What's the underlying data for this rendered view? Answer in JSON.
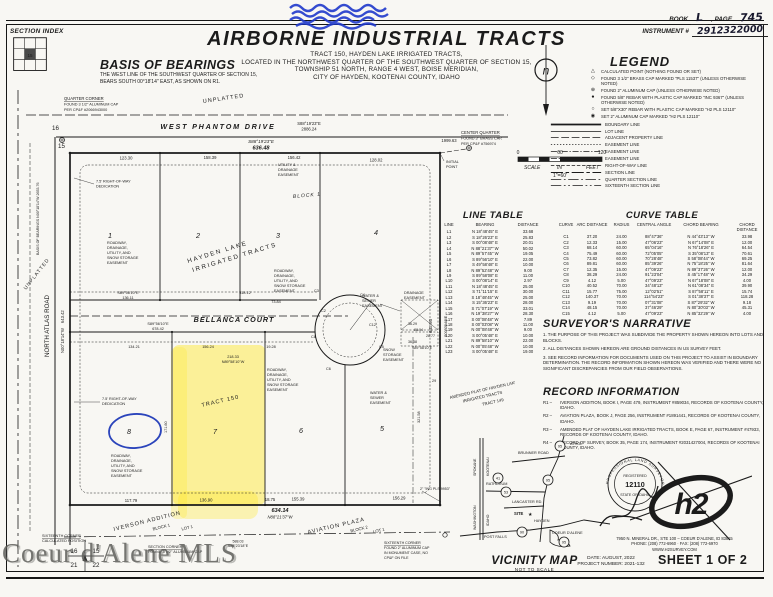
{
  "doc": {
    "section_index": {
      "label": "SECTION INDEX",
      "cell": "15"
    },
    "title": "AIRBORNE INDUSTRIAL TRACTS",
    "subtitle_lines": [
      "TRACT 150, HAYDEN LAKE IRRIGATED TRACTS,",
      "LOCATED IN THE NORTHWEST QUARTER OF THE SOUTHWEST QUARTER OF SECTION 15,",
      "TOWNSHIP 51 NORTH, RANGE 4 WEST, BOISE MERIDIAN,",
      "CITY OF HAYDEN, KOOTENAI COUNTY, IDAHO"
    ],
    "book": {
      "label": "BOOK",
      "value": "L",
      "page_label": ", PAGE",
      "page_value": "745",
      "instr_label": "INSTRUMENT #",
      "instr_value": "2912322000"
    },
    "watermark": "Coeur d'Alene MLS"
  },
  "basis": {
    "title": "BASIS OF BEARINGS",
    "body": "THE WEST LINE OF THE SOUTHWEST QUARTER OF SECTION 15, BEARS SOUTH 00°18'14\" EAST, AS SHOWN ON R1."
  },
  "north_arrow": {
    "letter": "n"
  },
  "scale": {
    "t0": "0",
    "t1": "60",
    "t2": "120",
    "w1": "SCALE",
    "w2": "IN",
    "w3": "FEET",
    "ratio": "1\"=60'"
  },
  "legend": {
    "title": "LEGEND",
    "points": [
      {
        "sym": "△",
        "text": "CALCULATED POINT (NOTHING FOUND OR SET)"
      },
      {
        "sym": "◇",
        "text": "FOUND 3 1/2\" BRASS CAP MARKED \"PLS 11537\" (UNLESS OTHERWISE NOTED)"
      },
      {
        "sym": "⊕",
        "text": "FOUND 2\" ALUMINUM CAP (UNLESS OTHERWISE NOTED)"
      },
      {
        "sym": "●",
        "text": "FOUND 5/8\" REBAR WITH PLASTIC CAP MARKED \"INC 9367\" (UNLESS OTHERWISE NOTED)"
      },
      {
        "sym": "○",
        "text": "SET 5/8\"X30\" REBAR WITH PLASTIC CAP MARKED \"H2 PLS 12110\""
      },
      {
        "sym": "◉",
        "text": "SET 2\" ALUMINUM CAP MARKED \"H2 PLS 12110\""
      }
    ],
    "lines": [
      {
        "dash": "",
        "w": "2",
        "text": "BOUNDARY LINE"
      },
      {
        "dash": "",
        "w": "1",
        "text": "LOT LINE"
      },
      {
        "dash": "9 3",
        "w": "1",
        "text": "ADJACENT PROPERTY LINE"
      },
      {
        "dash": "1.5 2",
        "w": "0.8",
        "text": "EASEMENT LINE"
      },
      {
        "dash": "7 2 1.5 2",
        "w": "0.8",
        "text": "EASEMENT LINE"
      },
      {
        "dash": "7 2 1.5 2 1.5 2",
        "w": "0.8",
        "text": "EASEMENT LINE"
      },
      {
        "dash": "4 2",
        "w": "0.8",
        "text": "RIGHT-OF-WAY LINE"
      },
      {
        "dash": "14 3 4 3",
        "w": "1.2",
        "text": "SECTION LINE"
      },
      {
        "dash": "12 3 2 3",
        "w": "1",
        "text": "QUARTER SECTION LINE"
      },
      {
        "dash": "12 3 2 3 2 3",
        "w": "1",
        "text": "SIXTEENTH SECTION LINE"
      }
    ]
  },
  "line_table": {
    "title": "LINE TABLE",
    "headers": [
      "LINE",
      "BEARING",
      "DISTANCE"
    ],
    "rows": [
      [
        "L1",
        "N 18°48'45\" E",
        "33.68"
      ],
      [
        "L2",
        "S 18°26'23\" E",
        "25.83"
      ],
      [
        "L3",
        "S 00°08'48\" E",
        "20.01"
      ],
      [
        "L4",
        "N 88°21'37\" W",
        "50.02"
      ],
      [
        "L5",
        "N 89°57'45\" W",
        "19.05"
      ],
      [
        "L6",
        "S 89°56'10\" E",
        "22.00"
      ],
      [
        "L7",
        "S 49°58'48\" E",
        "10.00"
      ],
      [
        "L8",
        "N 89°52'48\" W",
        "9.00"
      ],
      [
        "L9",
        "S 89°58'08\" E",
        "11.00"
      ],
      [
        "L10",
        "S 00°08'14\" E",
        "2.97"
      ],
      [
        "L11",
        "N 18°48'45\" E",
        "25.00"
      ],
      [
        "L12",
        "S 71°11'15\" E",
        "30.00"
      ],
      [
        "L13",
        "S 18°48'45\" W",
        "25.00"
      ],
      [
        "L14",
        "S 15°36'23\" E",
        "28.00"
      ],
      [
        "L15",
        "S 71°07'19\" W",
        "33.01"
      ],
      [
        "L16",
        "N 19°38'27\" W",
        "28.30"
      ],
      [
        "L17",
        "S 00°08'48\" W",
        "7.89"
      ],
      [
        "L18",
        "S 00°03'08\" W",
        "11.00"
      ],
      [
        "L19",
        "N 00°08'48\" W",
        "9.00"
      ],
      [
        "L20",
        "S 00°05'48\" E",
        "10.00"
      ],
      [
        "L21",
        "N 89°58'10\" W",
        "22.00"
      ],
      [
        "L22",
        "N 00°05'48\" W",
        "10.00"
      ],
      [
        "L23",
        "S 00°05'48\" E",
        "19.00"
      ]
    ]
  },
  "curve_table": {
    "title": "CURVE TABLE",
    "headers": [
      "CURVE",
      "ARC DISTANCE",
      "RADIUS",
      "CENTRAL ANGLE",
      "CHORD BEARING",
      "CHORD DISTANCE"
    ],
    "rows": [
      [
        "C1",
        "37.20",
        "24.00",
        "88°47'36\"",
        "N 44°43'13\" W",
        "33.98"
      ],
      [
        "C2",
        "12.33",
        "15.00",
        "47°06'23\"",
        "N 67°14'08\" E",
        "12.00"
      ],
      [
        "C3",
        "68.14",
        "60.00",
        "65°04'16\"",
        "N 76°18'26\" E",
        "64.54"
      ],
      [
        "C4",
        "75.49",
        "60.00",
        "72°05'05\"",
        "S 35°08'13\" E",
        "70.61"
      ],
      [
        "C5",
        "73.82",
        "60.00",
        "70°28'48\"",
        "S 58°08'44\" W",
        "69.25"
      ],
      [
        "C6",
        "89.81",
        "60.00",
        "85°39'26\"",
        "N 75°18'25\" W",
        "81.64"
      ],
      [
        "C7",
        "12.35",
        "15.00",
        "47°09'23\"",
        "N 89°37'26\" W",
        "12.00"
      ],
      [
        "C8",
        "38.29",
        "24.00",
        "91°23'04\"",
        "S 45°17'48\" W",
        "34.29"
      ],
      [
        "C9",
        "4.12",
        "5.00",
        "47°09'23\"",
        "N 67°18'08\" E",
        "4.00"
      ],
      [
        "C10",
        "40.52",
        "70.00",
        "34°48'13\"",
        "N 61°08'34\" E",
        "39.90"
      ],
      [
        "C11",
        "15.77",
        "75.00",
        "12°02'51\"",
        "S 87°58'11\" E",
        "15.74"
      ],
      [
        "C12",
        "140.37",
        "70.00",
        "114°54'23\"",
        "S 01°38'37\" E",
        "118.28"
      ],
      [
        "C13",
        "9.19",
        "70.00",
        "07°31'08\"",
        "S 87°29'32\" W",
        "9.18"
      ],
      [
        "C14",
        "48.15",
        "70.00",
        "37°46'29\"",
        "N 80°30'03\" W",
        "45.31"
      ],
      [
        "C15",
        "4.12",
        "5.00",
        "47°09'23\"",
        "N 85°32'29\" W",
        "4.00"
      ]
    ]
  },
  "narrative": {
    "title": "SURVEYOR'S NARRATIVE",
    "notes": [
      "1.  THE PURPOSE OF THIS PROJECT WAS SUBDIVIDE THE PROPERTY SHOWN HEREON INTO LOTS AND BLOCKS.",
      "2.  ALL DISTANCES SHOWN HEREON ARE GROUND DISTANCES IN US SURVEY FEET.",
      "3.  SEE RECORD INFORMATION FOR DOCUMENTS USED ON THIS PROJECT TO ASSIST IN BOUNDARY DETERMINATION. THE RECORD INFORMATION SHOWN HEREON WAS VERIFIED AND THERE WERE NO SIGNIFICANT DISCREPANCIES FROM OUR FIELD OBSERVATIONS."
    ]
  },
  "record": {
    "title": "RECORD INFORMATION",
    "items": [
      {
        "id": "R1 –",
        "text": "IVERSON ADDITION, BOOK I, PAGE 479, INSTRUMENT #859034, RECORDS OF KOOTENAI COUNTY, IDAHO."
      },
      {
        "id": "R2 –",
        "text": "AVIATION PLAZA, BOOK J, PAGE 256, INSTRUMENT #1891441, RECORDS OF KOOTENAI COUNTY, IDAHO."
      },
      {
        "id": "R3 –",
        "text": "AMENDED PLAT OF HAYDEN LAKE IRRIGATED TRACTS, BOOK E, PAGE 67, INSTRUMENT #47933, RECORDS OF KOOTENAI COUNTY, IDAHO."
      },
      {
        "id": "R4 –",
        "text": "RECORD OF SURVEY, BOOK 35, PAGE 174, INSTRUMENT #2031427004, RECORDS OF KOOTENAI COUNTY, IDAHO."
      }
    ]
  },
  "vicinity": {
    "title": "VICINITY MAP",
    "subtitle": "NOT TO SCALE",
    "labels": {
      "athol": "ATHOL",
      "brunner": "BRUNNER ROAD",
      "rathdrum": "RATHDRUM",
      "lancaster": "LANCASTER RD.",
      "site": "SITE",
      "hayden": "HAYDEN",
      "cda": "COEUR D'ALENE",
      "post_falls": "POST FALLS",
      "spokane": "SPOKANE",
      "kootenai": "KOOTENAI",
      "washington": "WASHINGTON",
      "idaho": "IDAHO"
    },
    "shields": [
      "95",
      "41",
      "53",
      "95",
      "90",
      "95"
    ]
  },
  "stamp": {
    "ring_top": "PROFESSIONAL LAND SURVEYOR",
    "ring_mid": "REGISTERED",
    "number": "12110",
    "ring_bottom": "STATE OF IDAHO"
  },
  "firm": {
    "logo": "h2",
    "address": "7950 N. MINERAL DR., STE 100 – COEUR D'ALENE, ID 83815",
    "phone": "PHONE: (208) 772-6960 · FAX: (208) 772-6970",
    "web": "WWW.H2SURVEY.COM"
  },
  "titleblock": {
    "date": "DATE: AUGUST, 2022",
    "project": "PROJECT NUMBER: 2021-132",
    "sheet": "SHEET 1 OF 2"
  },
  "plat": {
    "unplatted": "UNPLATTED",
    "qc1": "QUARTER CORNER",
    "qc2": "FOUND 3 1/2\" ALUMINUM CAP",
    "qc3": "PER CP&F #2066943000",
    "cq1": "CENTER QUARTER",
    "cq2": "FOUND 3\" BRASS CAP,",
    "cq3": "PER CP&F #756974",
    "ip1": "INITIAL",
    "ip2": "POINT",
    "west_phantom": "WEST PHANTOM DRIVE",
    "b1": "S88°19'23\"E",
    "d1": "636.48",
    "d2": "2886.24",
    "d3": "1999.63",
    "s15": "15",
    "s16": "16",
    "s21": "21",
    "s22": "22",
    "north_atlas": "NORTH ATLAS ROAD",
    "na_b": "N00°18'14\"W",
    "na_d": "643.42",
    "basis_line": "BASIS OF BEARINGS  N00°18'14\"W  2653.76",
    "row1": "7.5' RIGHT-OF-WAY",
    "row2": "DEDICATION",
    "block1": "BLOCK 1",
    "lot1": "1",
    "lot2": "2",
    "lot3": "3",
    "lot4": "4",
    "lot5": "5",
    "lot6": "6",
    "lot7": "7",
    "lot8": "8",
    "hl1": "HAYDEN LAKE",
    "hl2": "IRRIGATED TRACTS",
    "bellanca": "BELLANCA COURT",
    "bell_b": "S89°56'10\"E",
    "bell_d": "678.42",
    "tract150": "TRACT 150",
    "amended1": "AMENDED PLAT OF HAYDEN LAKE",
    "amended2": "IRRIGATED TRACTS",
    "amended3": "TRACT 149",
    "re1": "ROADWAY,",
    "re2": "DRAINAGE,",
    "re3": "UTILITY, AND",
    "re4": "SNOW STORAGE",
    "re5": "EASEMENT",
    "ud1": "UTILITY &",
    "ud2": "DRAINAGE",
    "ud3": "EASEMENT",
    "ws1": "WATER &",
    "ws2": "SEWER",
    "ws3": "EASEMENT",
    "de1": "DRAINAGE",
    "de2": "EASEMENT",
    "ss1": "SNOW",
    "ss2": "STORAGE",
    "ss3": "EASEMENT",
    "curves": {
      "c2": "C2",
      "c3": "C3",
      "c4": "C4",
      "c5": "C5",
      "c6": "C6",
      "c8": "C8",
      "c12": "C12"
    },
    "dims": {
      "t1": "123.30",
      "t2": "158.39",
      "t3": "156.42",
      "t4": "128.02",
      "m1": "S89°56'10\"E",
      "m2": "136.11",
      "m3": "318.12",
      "m4": "73.84",
      "m0": "134.21",
      "m5": "156.24",
      "m6": "19.28",
      "m7": "218.33",
      "m8": "N89°58'10\"W",
      "b1": "117.79",
      "b2": "136.90",
      "b3": "18.75",
      "b4": "155.39",
      "b5": "156.29",
      "total": "634.14",
      "total_b": "N88°21'37\"W",
      "six_d": "588.03",
      "six_b": "S88°23'18\"E",
      "right_d": "642.93",
      "right_b": "S00°05'48\"E",
      "r321": "321.58",
      "r29": "29",
      "v171": "171.60",
      "e1": "36.29",
      "e2": "88.04",
      "e3": "28.77",
      "e4": "36.38",
      "e5": "S89°58'10\"E"
    },
    "corners": {
      "sx1": "SIXTEENTH CORNER",
      "sx2": "CALCULATED POSITION",
      "sc1": "SECTION CORNER",
      "sc2": "FOUND 3 1/2\" ALUMINUM CAP",
      "sr1": "SIXTEENTH CORNER",
      "sr2": "FOUND 2\" ALUMINUM CAP",
      "sr3": "IN MONUMENT CASE, NO",
      "sr4": "CP&F ON FILE",
      "pls": "2\" \"ING PLS 9953\""
    },
    "iverson1": "IVERSON ADDITION",
    "iverson2": "BLOCK 1",
    "iverson3": "LOT 1",
    "aviation1": "AVIATION PLAZA",
    "aviation2": "BLOCK 2",
    "aviation3": "LOT 1"
  }
}
